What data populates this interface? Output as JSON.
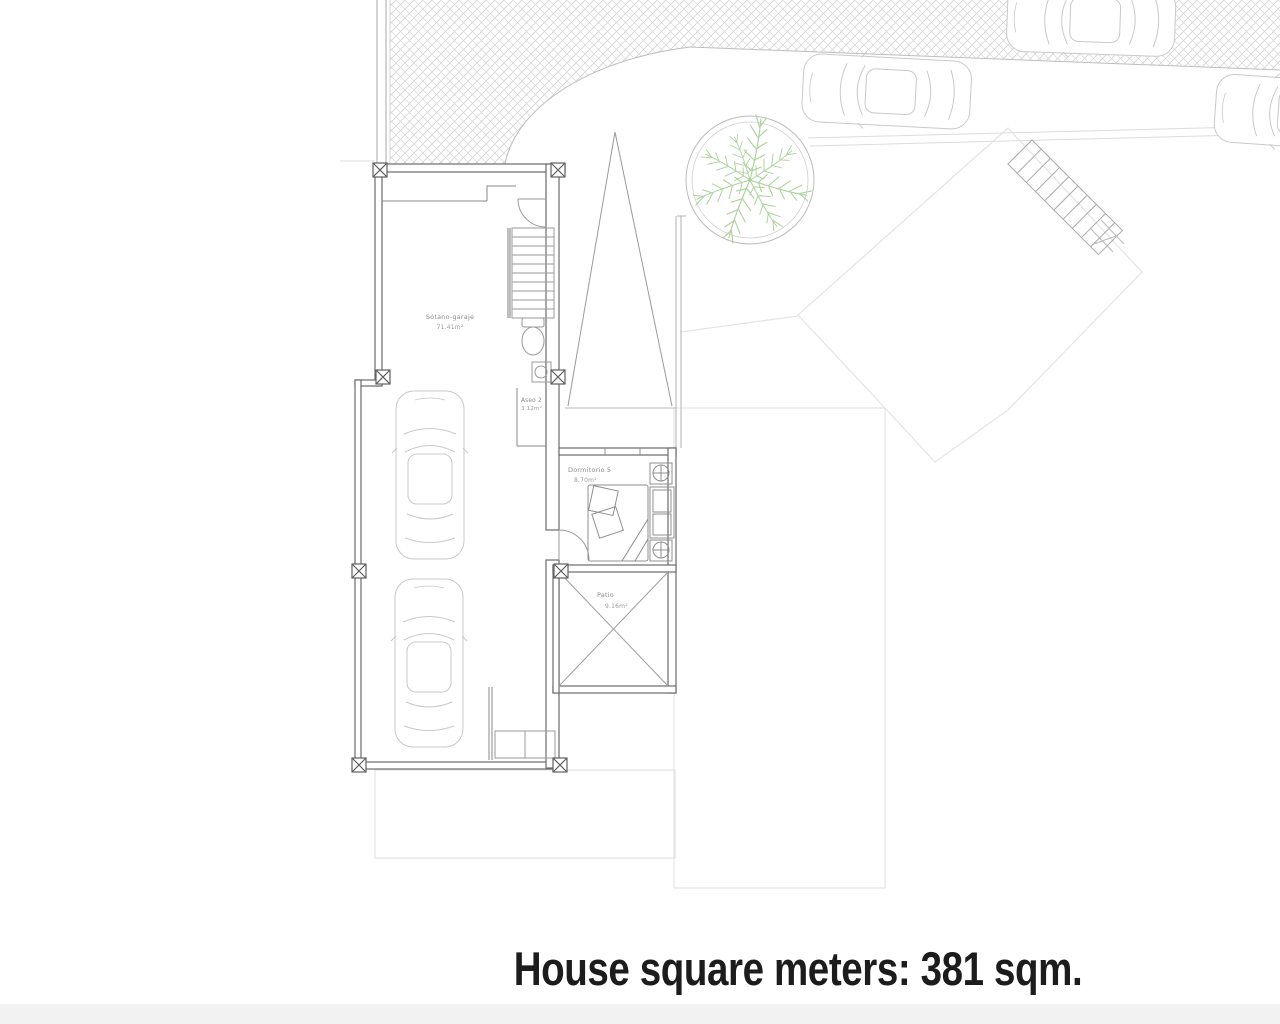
{
  "caption": {
    "text": "House square meters: 381 sqm."
  },
  "plan": {
    "level_type": "floor-plan",
    "rooms": [
      {
        "name": "Sótano-garaje",
        "area": "71.41m²"
      },
      {
        "name": "Aseo 2",
        "area": "3.12m²"
      },
      {
        "name": "Dormitorio 5",
        "area": "8.70m²"
      },
      {
        "name": "Patio",
        "area": "9.16m²"
      }
    ],
    "features": [
      "garage-car",
      "garage-car",
      "street-car",
      "street-car",
      "street-car",
      "palm-tree-planter",
      "herringbone-sidewalk",
      "interior-staircase",
      "exterior-staircase",
      "toilet",
      "sink",
      "bed",
      "wardrobe",
      "patio-cross"
    ]
  },
  "colors": {
    "page_bg": "#ffffff",
    "footer_strip": "#f2f2f2",
    "caption_text": "#1c1c1c",
    "wall_dark": "#6b6b6b",
    "line_mid": "#9a9a9a",
    "line_light": "#c9c9c9",
    "hatch": "#d2d2d2",
    "plot_light": "#e4e4e4",
    "palm_green": "#aed29e"
  }
}
